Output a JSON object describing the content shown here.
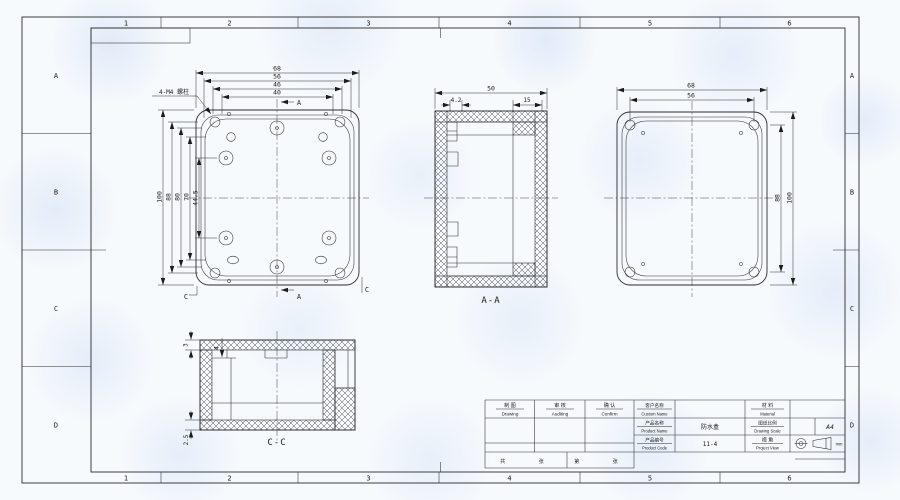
{
  "sheet": {
    "grid_cols": [
      "1",
      "2",
      "3",
      "4",
      "5",
      "6"
    ],
    "grid_rows": [
      "A",
      "B",
      "C",
      "D"
    ]
  },
  "front_view": {
    "callout": "4-M4 螺柱",
    "dim_w1": "68",
    "dim_w2": "56",
    "dim_w3": "46",
    "dim_w4": "40",
    "dim_h1": "100",
    "dim_h2": "88",
    "dim_h3": "80",
    "dim_h4": "70",
    "dim_h5": "44.5",
    "sec_a": "A",
    "sec_c": "C"
  },
  "section_aa": {
    "label": "A-A",
    "dim_w": "50",
    "dim_wall": "4.2",
    "dim_lid": "15"
  },
  "back_view": {
    "dim_w1": "68",
    "dim_w2": "56",
    "dim_h1": "88",
    "dim_h2": "100"
  },
  "section_cc": {
    "label": "C-C",
    "dim_top": "3",
    "dim_step": "4",
    "dim_bottom": "2.5"
  },
  "title_block": {
    "drawing_zh": "制 图",
    "drawing_en": "Drawing",
    "auditing_zh": "审 核",
    "auditing_en": "Auditing",
    "confirm_zh": "确 认",
    "confirm_en": "Confirm",
    "custom_name_zh": "客户名称",
    "custom_name_en": "Custom Name",
    "custom_name_value": "",
    "material_zh": "材 料",
    "material_en": "Material",
    "material_value": "",
    "product_name_zh": "产品名称",
    "product_name_en": "Product Name",
    "product_name_value": "防水盒",
    "scale_zh": "图纸比例",
    "scale_en": "Drawing Scale",
    "scale_value": "",
    "code_zh": "产品编号",
    "code_en": "Product Code",
    "code_value": "11-4",
    "view_zh": "视 角",
    "view_en": "Project View",
    "paper_size": "A4",
    "unit": "mm",
    "pages_left": "共 张",
    "pages_right": "第 张"
  }
}
